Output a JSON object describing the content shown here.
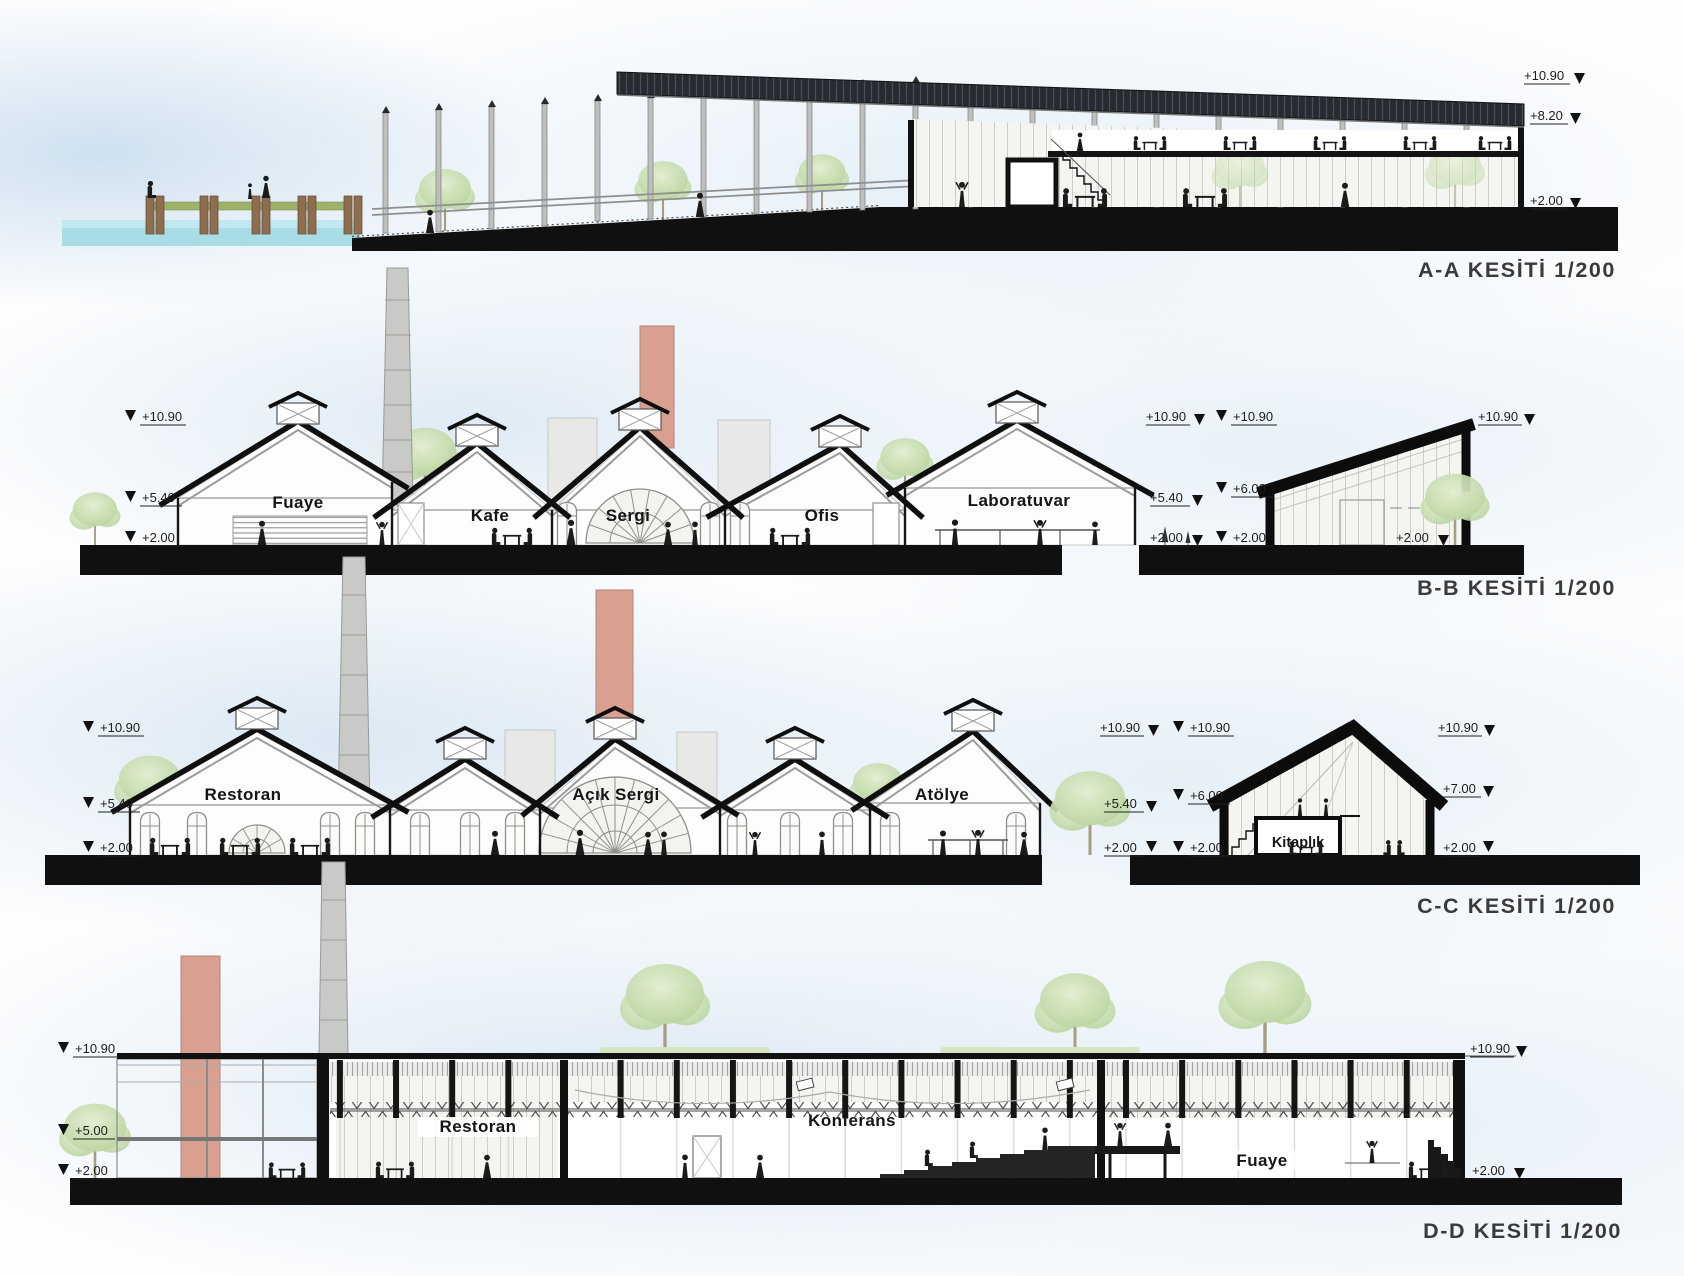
{
  "sheet": {
    "type": "architectural-section-drawings"
  },
  "sections": {
    "aa": {
      "title": "A-A KESİTİ 1/200",
      "elev": {
        "e1090": "+10.90",
        "e820": "+8.20",
        "e200": "+2.00"
      }
    },
    "bb": {
      "title": "B-B KESİTİ 1/200",
      "rooms": {
        "fuaye": "Fuaye",
        "kafe": "Kafe",
        "sergi": "Sergi",
        "ofis": "Ofis",
        "laboratuvar": "Laboratuvar"
      },
      "elev": {
        "e1090": "+10.90",
        "e540": "+5.40",
        "e600": "+6.00",
        "e200": "+2.00"
      }
    },
    "cc": {
      "title": "C-C KESİTİ 1/200",
      "rooms": {
        "restoran": "Restoran",
        "acik_sergi": "Açık Sergi",
        "atolye": "Atölye",
        "kitaplik": "Kitaplık"
      },
      "elev": {
        "e1090": "+10.90",
        "e540": "+5.40",
        "e600": "+6.00",
        "e700": "+7.00",
        "e200": "+2.00"
      }
    },
    "dd": {
      "title": "D-D KESİTİ 1/200",
      "rooms": {
        "restoran": "Restoran",
        "konferans": "Konferans",
        "fuaye": "Fuaye"
      },
      "elev": {
        "e1090": "+10.90",
        "e500": "+5.00",
        "e200": "+2.00"
      }
    }
  },
  "colors": {
    "ink": "#141414",
    "roof_dark": "#262b30",
    "chimney_pink": "#d9a08f",
    "chimney_gray": "#c9c9c7",
    "water": "#a8dde8",
    "grass": "#9fb26a",
    "tree_green": "#bdd6a2",
    "sky_wash": "#cfe0ef"
  }
}
